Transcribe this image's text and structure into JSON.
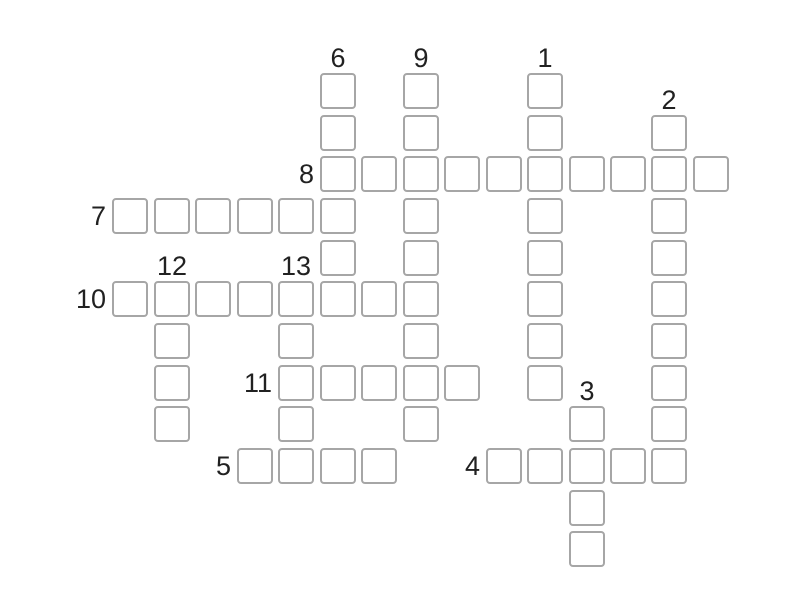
{
  "page": {
    "background": "#ffffff",
    "width": 800,
    "height": 600
  },
  "grid": {
    "cell_size": 36,
    "cell_fill": "#ffffff",
    "border_color": "#a6a6a6",
    "border_width": 2,
    "corner_radius": 4,
    "col_x": [
      112,
      154,
      195,
      237,
      278,
      320,
      361,
      403,
      444,
      486,
      527,
      569,
      610,
      651,
      693
    ],
    "row_y": [
      73,
      115,
      156,
      198,
      240,
      281,
      323,
      365,
      406,
      448,
      490,
      531
    ],
    "label": {
      "color": "#212121",
      "font_size": 27,
      "across_gap": 6,
      "down_gap": 5
    }
  },
  "entries": {
    "across": [
      {
        "number": "8",
        "row": 2,
        "col": 5,
        "length": 10
      },
      {
        "number": "7",
        "row": 3,
        "col": 0,
        "length": 6
      },
      {
        "number": "10",
        "row": 5,
        "col": 0,
        "length": 8
      },
      {
        "number": "11",
        "row": 7,
        "col": 4,
        "length": 5
      },
      {
        "number": "5",
        "row": 9,
        "col": 3,
        "length": 4
      },
      {
        "number": "4",
        "row": 9,
        "col": 9,
        "length": 5
      }
    ],
    "down": [
      {
        "number": "6",
        "row": 0,
        "col": 5,
        "length": 6
      },
      {
        "number": "9",
        "row": 0,
        "col": 7,
        "length": 9
      },
      {
        "number": "1",
        "row": 0,
        "col": 10,
        "length": 8
      },
      {
        "number": "2",
        "row": 1,
        "col": 13,
        "length": 9
      },
      {
        "number": "12",
        "row": 5,
        "col": 1,
        "length": 4
      },
      {
        "number": "13",
        "row": 5,
        "col": 4,
        "length": 5
      },
      {
        "number": "3",
        "row": 8,
        "col": 11,
        "length": 4
      }
    ]
  }
}
